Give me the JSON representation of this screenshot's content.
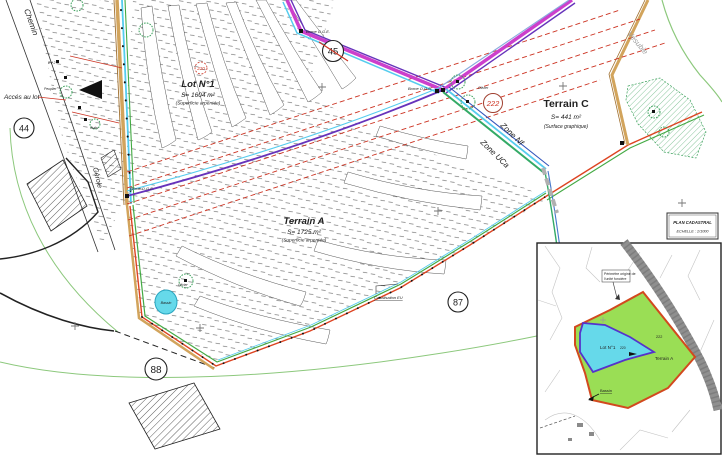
{
  "colors": {
    "magenta": "#cc3fcc",
    "purple": "#6633bb",
    "cyan": "#55ccee",
    "teal": "#33aa66",
    "road-tan": "#d2a45c",
    "road-brown": "#a07030",
    "red": "#cc3322",
    "boundary-red": "#dd4422",
    "green": "#44aa44",
    "light-green": "#8cc87c",
    "zone-gray": "#b0b0b0",
    "lot-blue": "#66d9ea",
    "parcel-green": "#9ade55",
    "inset-red": "#d2491e",
    "inset-purple": "#5533cc",
    "gray-road": "#8f8f8f"
  },
  "labels": {
    "chemin": "Chemin",
    "acces_au_lot": "Accés au lot",
    "gerole": "Gérole",
    "vesubie": "Vésubie",
    "zone_nf": "Zone Nf",
    "zone_uca": "Zone UCa",
    "canalisation": "Canalisation EU",
    "bassin": "Bassin",
    "olivier_right": "Olivier",
    "olivier_left": "Olivier",
    "puits": "Puits",
    "peuplier": "Peuplier",
    "ev2": "EV 2",
    "borne_oge_top": "Borne O.G.E.",
    "borne_ogb": "Borne O.G.B.",
    "borne_oge_left": "Borne O.G.E."
  },
  "circles": {
    "c44": "44",
    "c45": "45",
    "c87": "87",
    "c88": "88",
    "c222": "222",
    "c220": "220"
  },
  "parcels": {
    "lot1": {
      "name": "Lot N°1",
      "area": "S= 1604 m²",
      "note": "(Superficie arpentée)"
    },
    "terrain_a": {
      "name": "Terrain A",
      "area": "S= 1725 m²",
      "note": "(Superficie arpentée)"
    },
    "terrain_c": {
      "name": "Terrain C",
      "area": "S= 441 m²",
      "note": "(Surface graphique)"
    }
  },
  "inset": {
    "title_line1": "PLAN CADASTRAL",
    "title_line2": "ECHELLE : 1/1000",
    "perimeter_note_line1": "Périmètre origine de",
    "perimeter_note_line2": "l'unité foncière",
    "lot1_label": "Lot N°1",
    "lot1_number": "220",
    "terrain_a_label": "Terrain A",
    "terrain_a_number": "222",
    "bassin_label": "Bassin"
  }
}
